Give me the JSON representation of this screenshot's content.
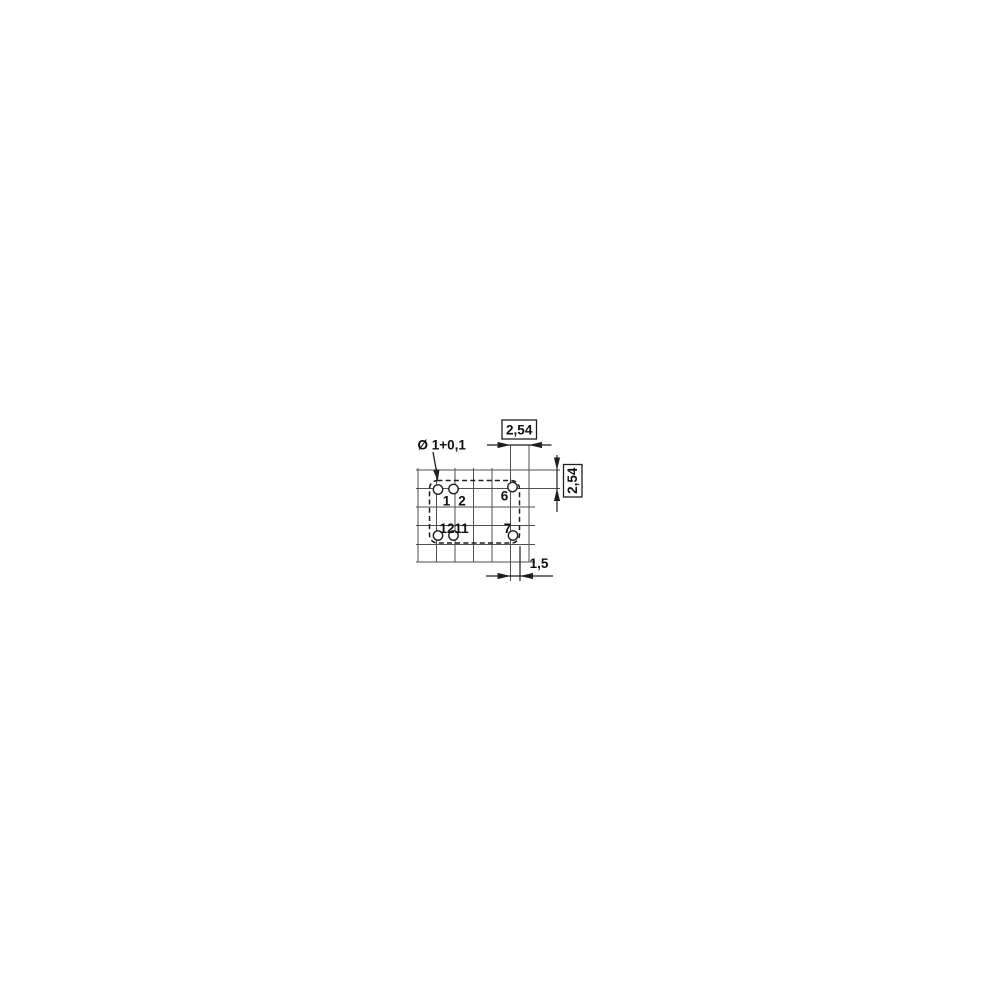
{
  "diagram": {
    "hole_diameter_label": "Ø 1+0,1",
    "dimensions": {
      "horizontal_pitch": "2,54",
      "vertical_pitch": "2,54",
      "edge_offset": "1,5"
    },
    "pins": [
      {
        "number": "1",
        "hole": {
          "cx": 438,
          "cy": 489.5
        },
        "label": {
          "x": 446.5,
          "y": 505.5
        }
      },
      {
        "number": "2",
        "hole": {
          "cx": 453.5,
          "cy": 489
        },
        "label": {
          "x": 462,
          "y": 505.5
        }
      },
      {
        "number": "6",
        "hole": {
          "cx": 512.5,
          "cy": 487
        },
        "label": {
          "x": 504.5,
          "y": 500.5
        }
      },
      {
        "number": "12",
        "hole": {
          "cx": 438,
          "cy": 535.5
        },
        "label": {
          "x": 447,
          "y": 533
        }
      },
      {
        "number": "11",
        "hole": {
          "cx": 453.5,
          "cy": 535.5
        },
        "label": {
          "x": 461.5,
          "y": 533
        }
      },
      {
        "number": "7",
        "hole": {
          "cx": 513,
          "cy": 535.5
        },
        "label": {
          "x": 507.5,
          "y": 533
        }
      }
    ],
    "colors": {
      "grid_line": "#4f4f4f",
      "drawing_line": "#1f1f1f",
      "text": "#111111",
      "background": "#ffffff"
    }
  }
}
